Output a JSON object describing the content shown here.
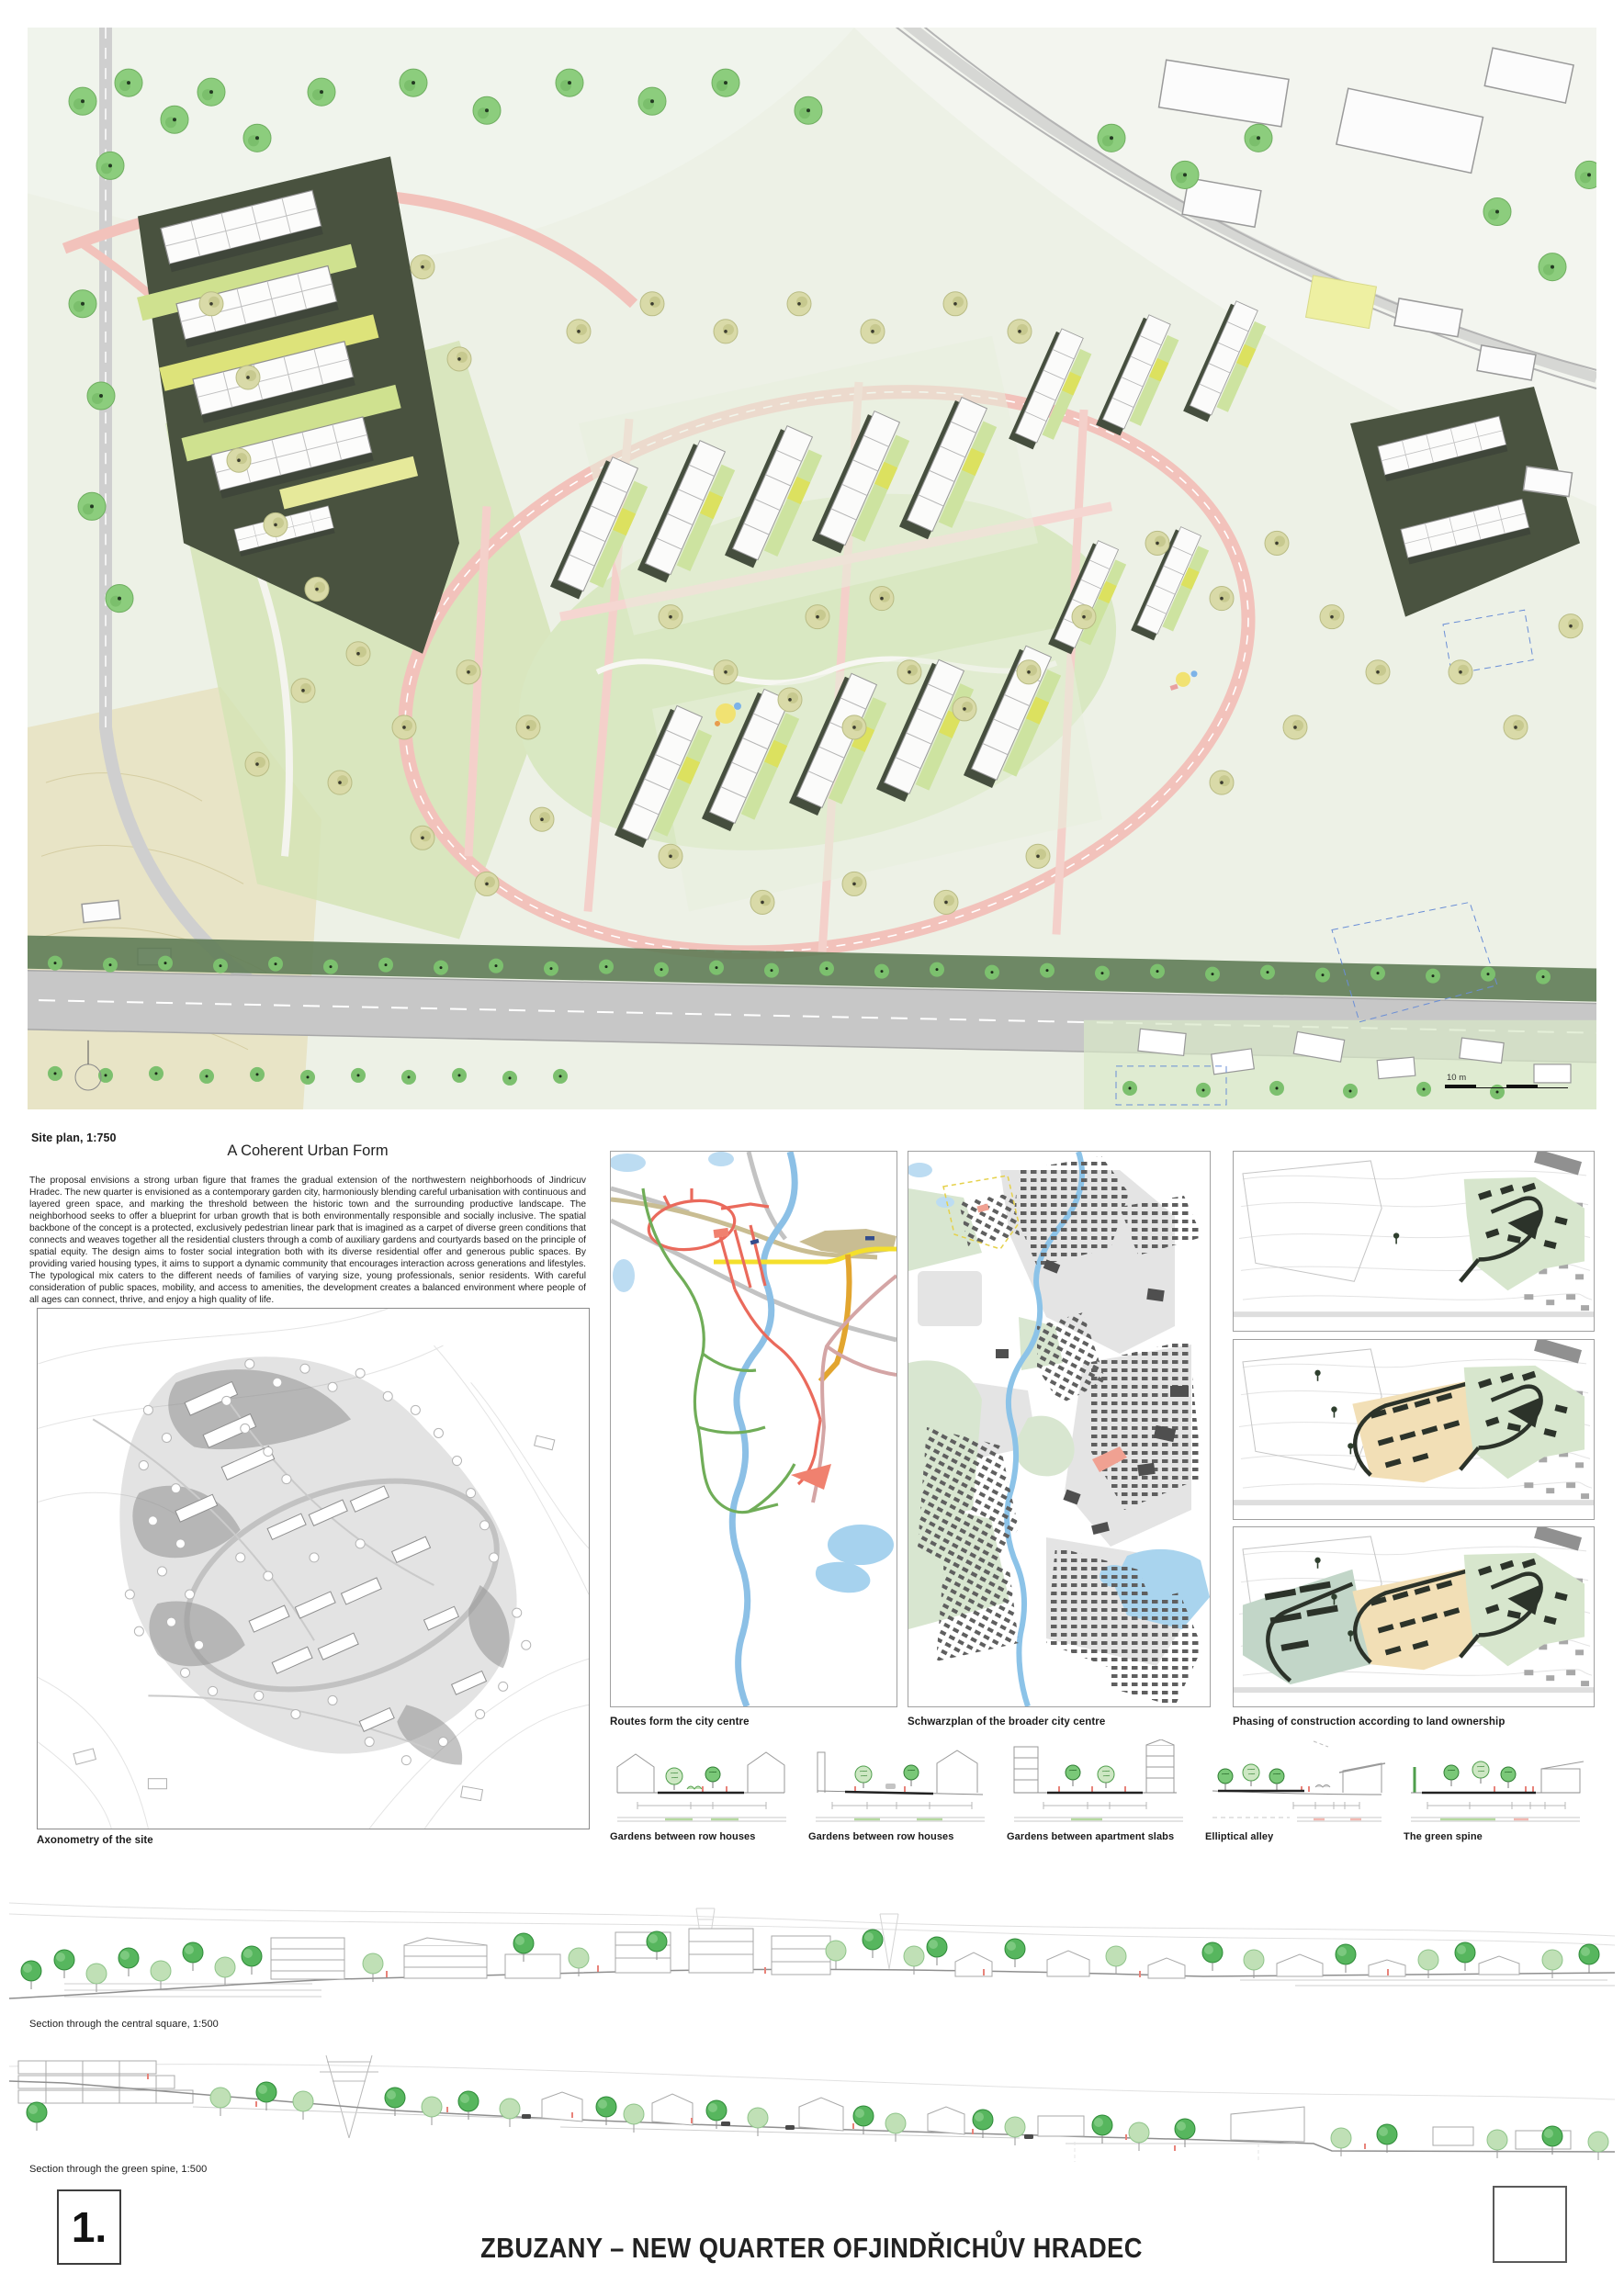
{
  "poster": {
    "panel_number": "1.",
    "title": "ZBUZANY – NEW QUARTER OFJINDŘICHŮV HRADEC"
  },
  "site_plan": {
    "caption": "Site plan, 1:750",
    "scale_label": "10 m"
  },
  "narrative": {
    "heading": "A Coherent Urban Form",
    "body": "The proposal envisions a strong urban figure that frames the gradual extension of the northwestern neighborhoods of Jindricuv Hradec. The new quarter is envisioned as a contemporary garden city, harmoniously blending careful urbanisation with continuous and layered green space, and marking the threshold between the historic town and the surrounding productive landscape. The neighborhood seeks to offer a blueprint for urban growth that is both environmentally responsible and socially inclusive. The spatial backbone of the concept is a protected, exclusively pedestrian linear park that is imagined as a carpet of diverse green conditions that connects and weaves together all the residential clusters through a comb of auxiliary gardens and courtyards based on the principle of spatial equity. The design aims to foster social integration both with its diverse residential offer and generous public spaces. By providing varied housing types, it aims to support a dynamic community that encourages interaction across generations and lifestyles. The typological mix caters to the different needs of families of varying size, young professionals, senior residents. With careful consideration of public spaces, mobility, and access to amenities, the development creates a balanced environment where people of all ages can connect, thrive, and enjoy a high quality of life."
  },
  "panels": {
    "axonometry_caption": "Axonometry of the site",
    "routes_caption": "Routes form the city centre",
    "schwarzplan_caption": "Schwarzplan of the broader city centre",
    "phasing_caption": "Phasing of construction according to land ownership"
  },
  "street_sections": {
    "captions": [
      "Gardens between row houses",
      "Gardens between row houses",
      "Gardens between apartment slabs",
      "Elliptical alley",
      "The green spine"
    ]
  },
  "long_sections": {
    "captions": [
      "Section through the central square, 1:500",
      "Section through the green spine, 1:500"
    ]
  },
  "colors": {
    "tree_green": "#8ccd7d",
    "tree_olive": "#d9daa8",
    "road_pink": "#f2c2bb",
    "cluster_dark_green": "#49523f",
    "field_beige": "#e8e4c6",
    "river_blue": "#8cc0e6",
    "route_red": "#ea6a5c",
    "route_green": "#70ad58",
    "route_yellow": "#f4df2c",
    "route_orange": "#e2a52f",
    "route_rose": "#d4a5a5",
    "phase_green": "#d7e6cd",
    "phase_tan": "#f2dfb6",
    "phase_sage": "#c2d6c8",
    "section_accent_red": "#e8837a"
  }
}
